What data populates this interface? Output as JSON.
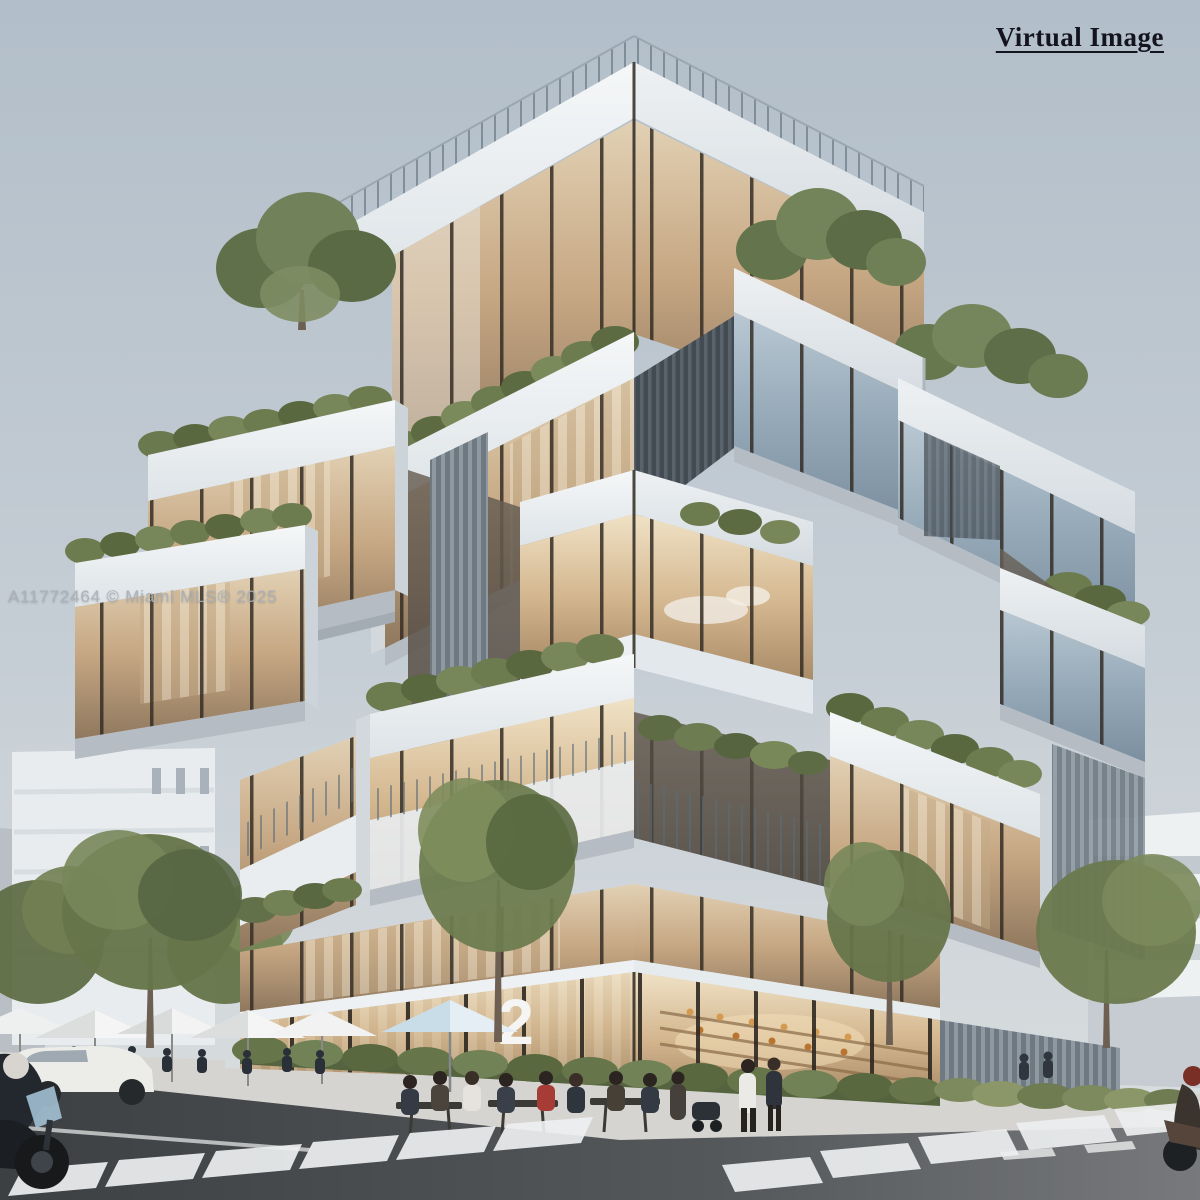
{
  "overlays": {
    "virtual_image_label": "Virtual Image",
    "watermark": "A11772464 © Miami MLS® 2025"
  },
  "building": {
    "unit_number": "2",
    "visible_floors": 7,
    "subject": "modern corner building of stacked cantilevered glass boxes with white frames and planted terraces"
  },
  "street_scene": {
    "umbrella_count": 6,
    "crosswalk_count": 2,
    "vehicles": [
      "motorcycle",
      "white car",
      "scooter"
    ],
    "features": [
      "corner cafe with outdoor seating",
      "ground-floor bakery storefront",
      "street trees",
      "hedge planters"
    ]
  },
  "palette": {
    "sky_top": "#b2bec9",
    "sky_bottom": "#dbdfe0",
    "concrete": "#f2f4f6",
    "soffit": "#b5bcc3",
    "glass_warm": "#c6a783",
    "glass_cool": "#93a7b6",
    "mullion": "#352e26",
    "greenery": "#6d7c4f",
    "road": "#46494c",
    "crosswalk_stripe": "#edeff0",
    "label_text": "#14141f",
    "watermark_text": "#a8afb6"
  }
}
